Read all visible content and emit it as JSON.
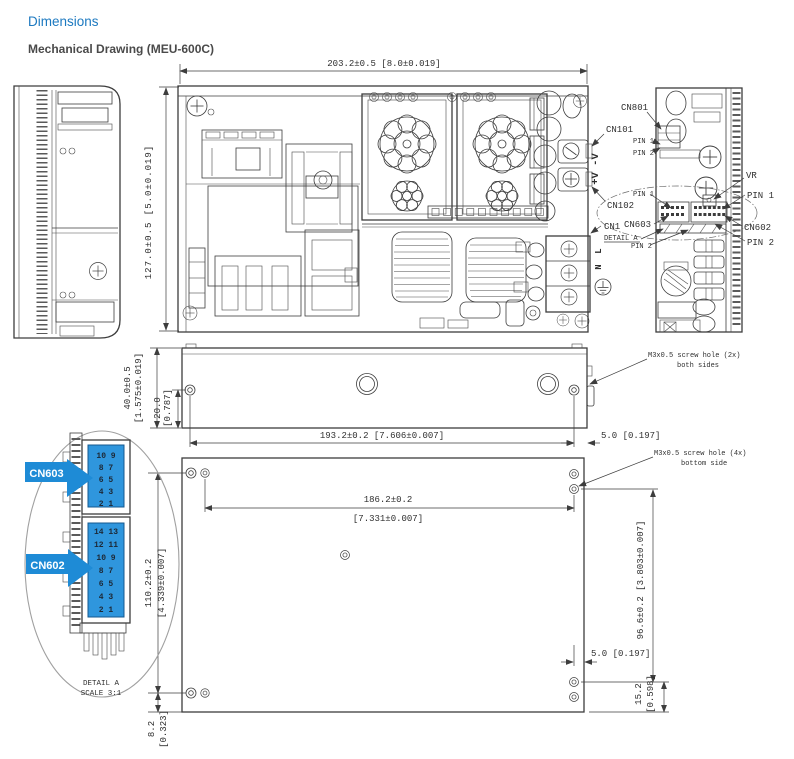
{
  "header": {
    "page_title": "Dimensions",
    "drawing_title": "Mechanical Drawing (MEU-600C)"
  },
  "colors": {
    "accent_blue": "#1c79c0",
    "highlight_blue": "#1e8bd6",
    "connector_fill": "#2f96dd",
    "line": "#3d3d3d"
  },
  "top_view": {
    "width_dim": "203.2±0.5 [8.0±0.019]",
    "height_dim": "127.0±0.5 [5.0±0.019]",
    "labels": {
      "cn801": "CN801",
      "cn101": "CN101",
      "cn102": "CN102",
      "cn1": "CN1",
      "cn603": "CN603",
      "detail_a": "DETAIL A",
      "pin1": "PIN 1",
      "pin2": "PIN 2",
      "output": "+V -V",
      "vr": "VR",
      "cn602": "CN602",
      "line": "L",
      "neutral": "N"
    }
  },
  "side_view": {
    "height_mm": "40.0±0.5",
    "height_in": "[1.575±0.019]",
    "hole_mm": "20.0",
    "hole_in": "[0.787]",
    "length_dim": "193.2±0.2 [7.606±0.007]",
    "offset_dim": "5.0 [0.197]",
    "screw_note_1": "M3x0.5 screw hole (2x)",
    "screw_note_2": "both sides"
  },
  "bottom_view": {
    "screw_note_1": "M3x0.5 screw hole (4x)",
    "screw_note_2": "bottom side",
    "span_mm": "186.2±0.2",
    "span_in": "[7.331±0.007]",
    "height_mm": "110.2±0.2",
    "height_in": "[4.339±0.007]",
    "edge_mm": "8.2",
    "edge_in": "[0.323]",
    "right_dim": "96.6±0.2 [3.803±0.007]",
    "offset_dim": "5.0 [0.197]",
    "corner_mm": "15.2",
    "corner_in": "[0.598]"
  },
  "detail_view": {
    "cn603": "CN603",
    "cn602": "CN602",
    "caption_1": "DETAIL A",
    "caption_2": "SCALE 3:1",
    "cn603_pins": [
      "10 9",
      "8 7",
      "6 5",
      "4 3",
      "2 1"
    ],
    "cn602_pins": [
      "14 13",
      "12 11",
      "10 9",
      "8 7",
      "6 5",
      "4 3",
      "2 1"
    ]
  }
}
